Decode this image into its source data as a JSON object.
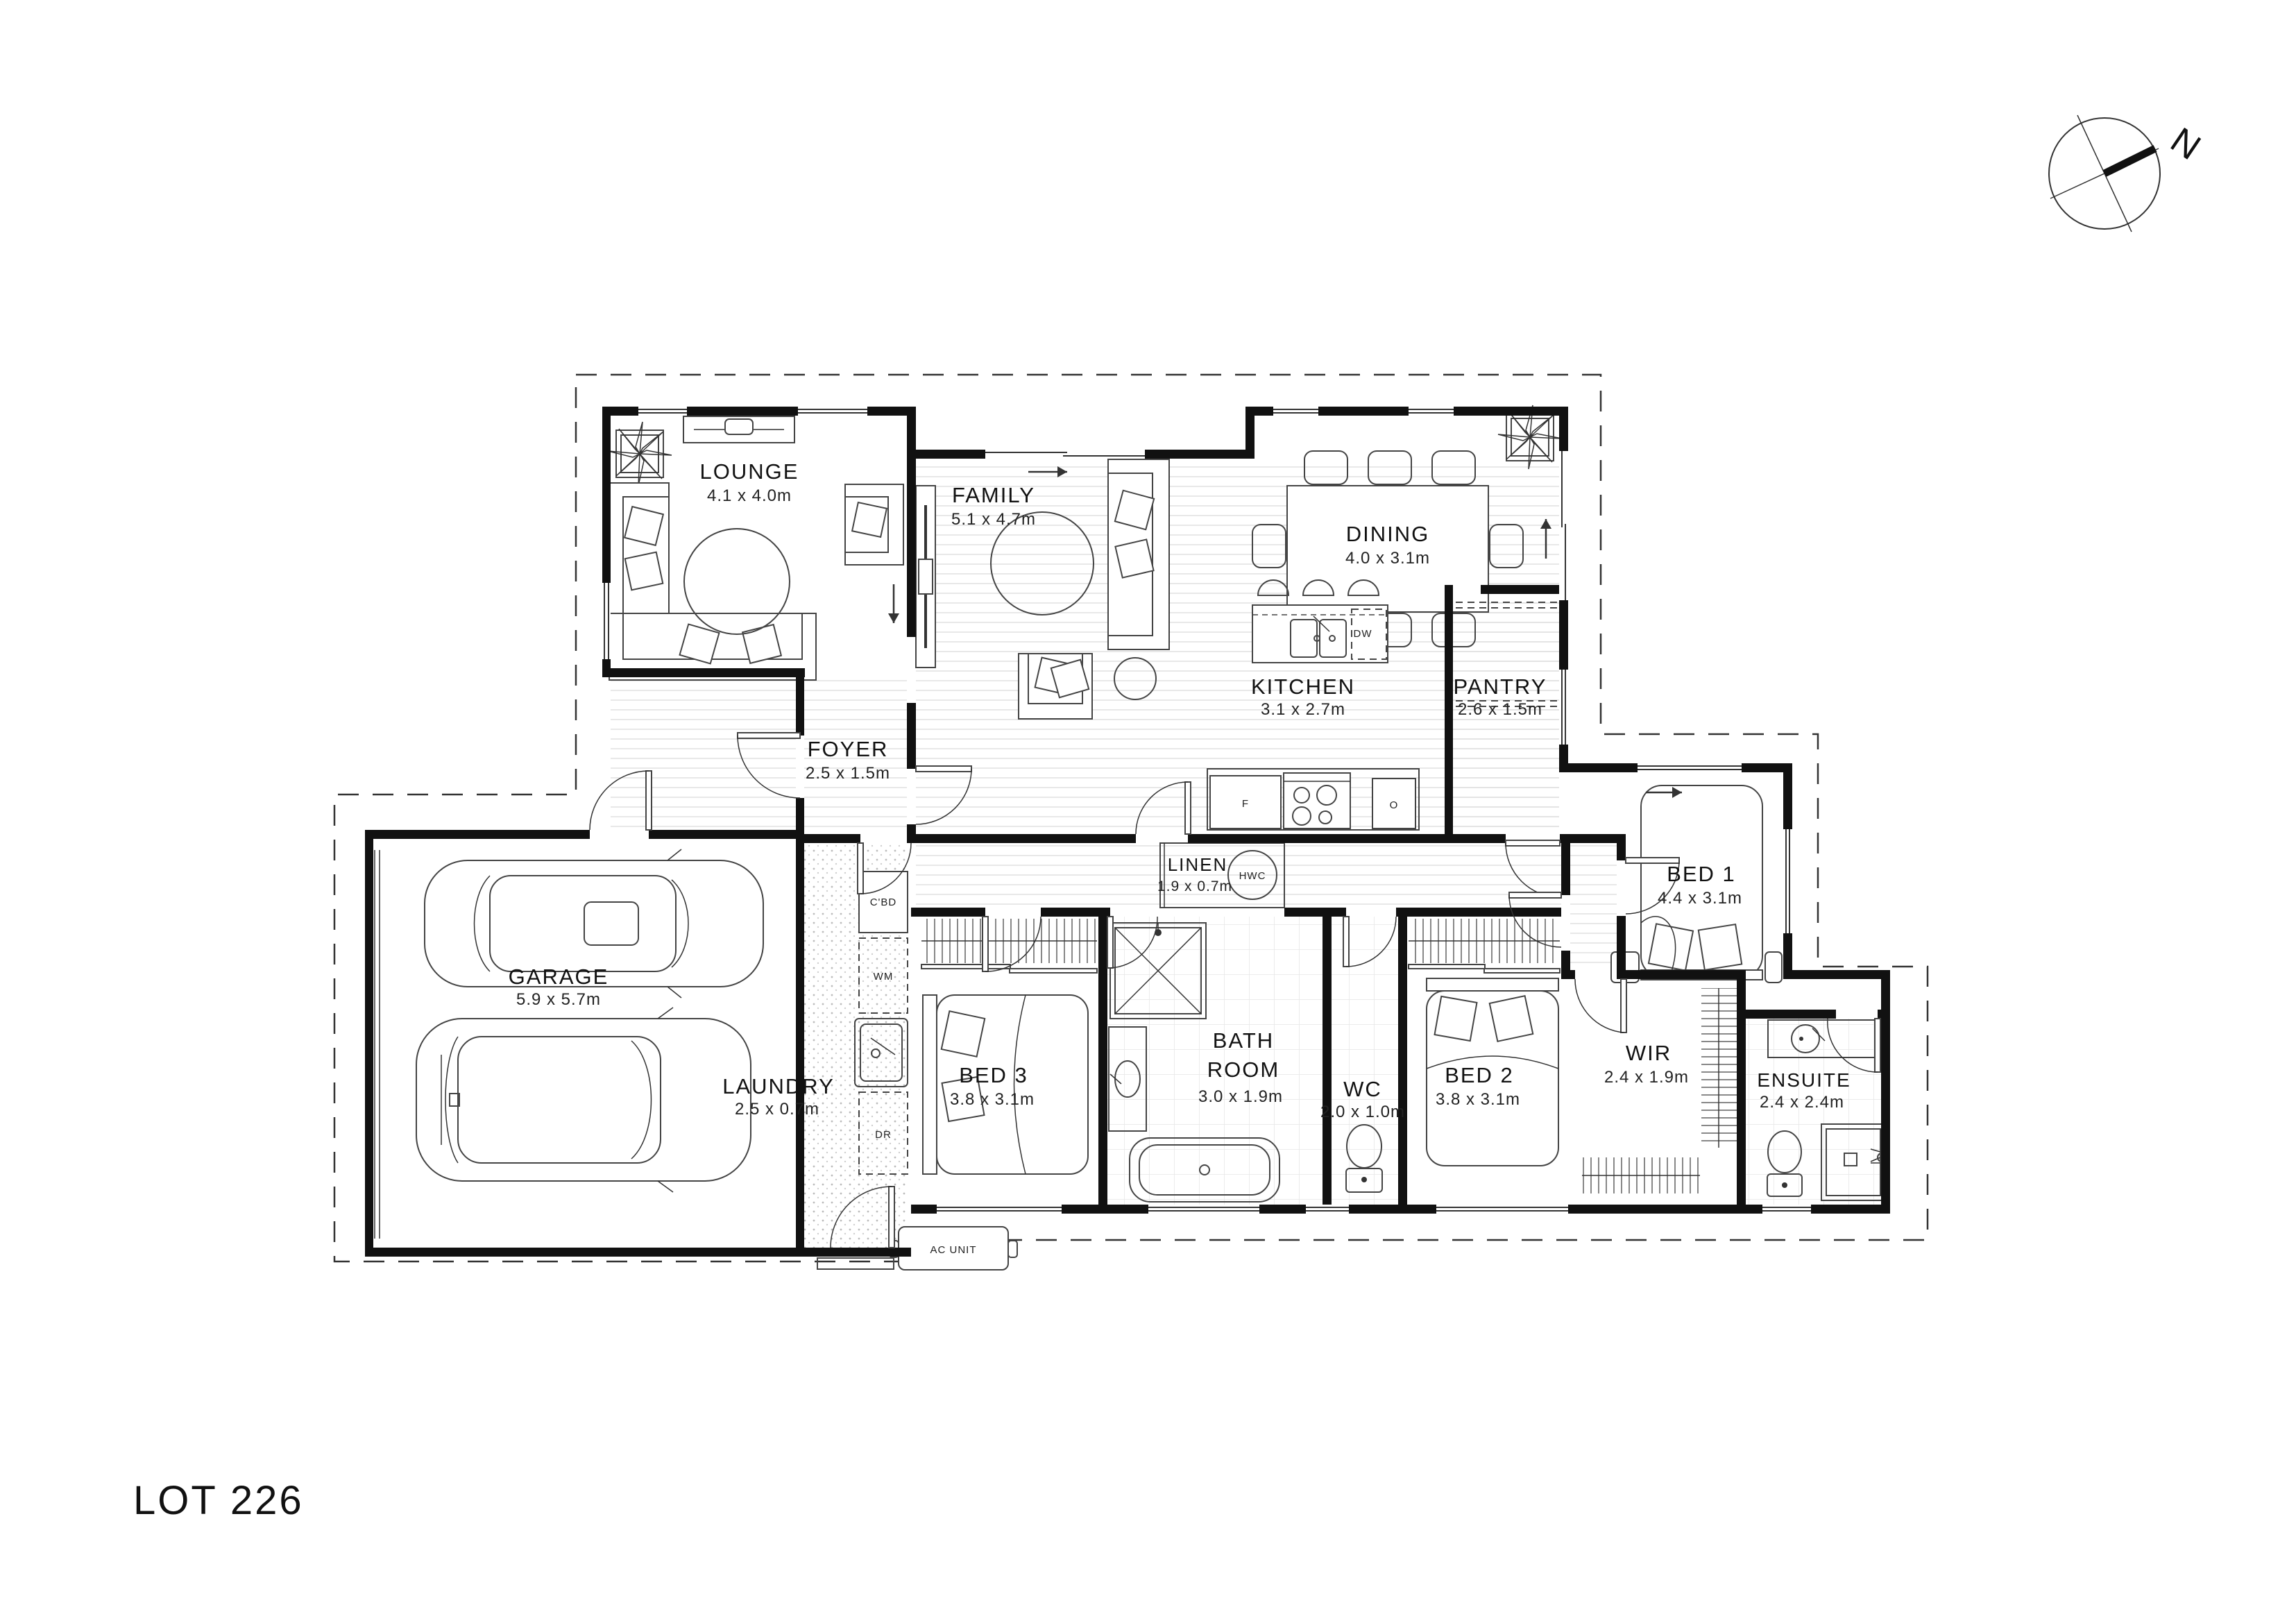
{
  "title": "LOT 226",
  "compass": {
    "north": "N"
  },
  "rooms": [
    {
      "key": "lounge",
      "name": "LOUNGE",
      "dims": "4.1 x 4.0m"
    },
    {
      "key": "family",
      "name": "FAMILY",
      "dims": "5.1 x 4.7m"
    },
    {
      "key": "dining",
      "name": "DINING",
      "dims": "4.0 x 3.1m"
    },
    {
      "key": "kitchen",
      "name": "KITCHEN",
      "dims": "3.1 x 2.7m"
    },
    {
      "key": "pantry",
      "name": "PANTRY",
      "dims": "2.6 x 1.5m"
    },
    {
      "key": "foyer",
      "name": "FOYER",
      "dims": "2.5 x 1.5m"
    },
    {
      "key": "garage",
      "name": "GARAGE",
      "dims": "5.9 x 5.7m"
    },
    {
      "key": "laundry",
      "name": "LAUNDRY",
      "dims": "2.5 x 0.7m"
    },
    {
      "key": "bed3",
      "name": "BED 3",
      "dims": "3.8 x 3.1m"
    },
    {
      "key": "linen",
      "name": "LINEN",
      "dims": "1.9 x 0.7m"
    },
    {
      "key": "bathroom",
      "name": "BATH ROOM",
      "name_line1": "BATH",
      "name_line2": "ROOM",
      "dims": "3.0 x 1.9m"
    },
    {
      "key": "wc",
      "name": "WC",
      "dims": "2.0 x 1.0m"
    },
    {
      "key": "bed2",
      "name": "BED 2",
      "dims": "3.8 x 3.1m"
    },
    {
      "key": "bed1",
      "name": "BED 1",
      "dims": "4.4 x 3.1m"
    },
    {
      "key": "wir",
      "name": "WIR",
      "dims": "2.4 x 1.9m"
    },
    {
      "key": "ensuite",
      "name": "ENSUITE",
      "dims": "2.4 x 2.4m"
    }
  ],
  "labels": {
    "dishwasher": "DW",
    "fridge": "F",
    "oven": "O",
    "hot_water_cylinder": "HWC",
    "cupboard": "C'BD",
    "washing_machine": "WM",
    "dryer": "DR",
    "ac_unit": "AC UNIT"
  },
  "colors": {
    "walls": "#111111",
    "lines": "#444444",
    "floor_hatch": "#e2e2e2"
  }
}
